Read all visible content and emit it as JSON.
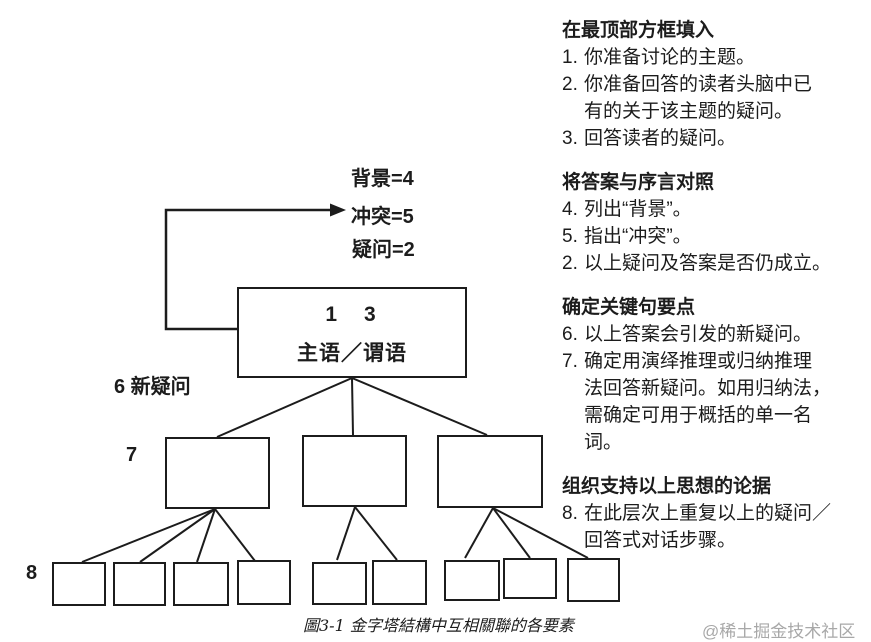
{
  "colors": {
    "ink": "#1c1c1c",
    "watermark": "#a8a8a8",
    "background": "#ffffff"
  },
  "diagram": {
    "preface_labels": {
      "background": "背景=4",
      "conflict": "冲突=5",
      "question": "疑问=2"
    },
    "arrow_icon": "right-arrow",
    "top_box": {
      "numbers": "1　3",
      "label": "主语／谓语"
    },
    "side_labels": {
      "new_question": "6 新疑问",
      "level7": "7",
      "level8": "8"
    }
  },
  "right_column": {
    "sections": [
      {
        "heading": "在最顶部方框填入",
        "items": [
          {
            "num": "1.",
            "text": "你准备讨论的主题。"
          },
          {
            "num": "2.",
            "text": "你准备回答的读者头脑中已\n有的关于该主题的疑问。"
          },
          {
            "num": "3.",
            "text": "回答读者的疑问。"
          }
        ]
      },
      {
        "heading": "将答案与序言对照",
        "items": [
          {
            "num": "4.",
            "text": "列出“背景”。"
          },
          {
            "num": "5.",
            "text": "指出“冲突”。"
          },
          {
            "num": "2.",
            "text": "以上疑问及答案是否仍成立。"
          }
        ]
      },
      {
        "heading": "确定关键句要点",
        "items": [
          {
            "num": "6.",
            "text": "以上答案会引发的新疑问。"
          },
          {
            "num": "7.",
            "text": "确定用演绎推理或归纳推理\n法回答新疑问。如用归纳法，\n需确定可用于概括的单一名\n词。"
          }
        ]
      },
      {
        "heading": "组织支持以上思想的论据",
        "items": [
          {
            "num": "8.",
            "text": "在此层次上重复以上的疑问／\n回答式对话步骤。"
          }
        ]
      }
    ]
  },
  "caption": "圖3-1 金字塔結構中互相關聯的各要素",
  "watermark": "@稀土掘金技术社区"
}
